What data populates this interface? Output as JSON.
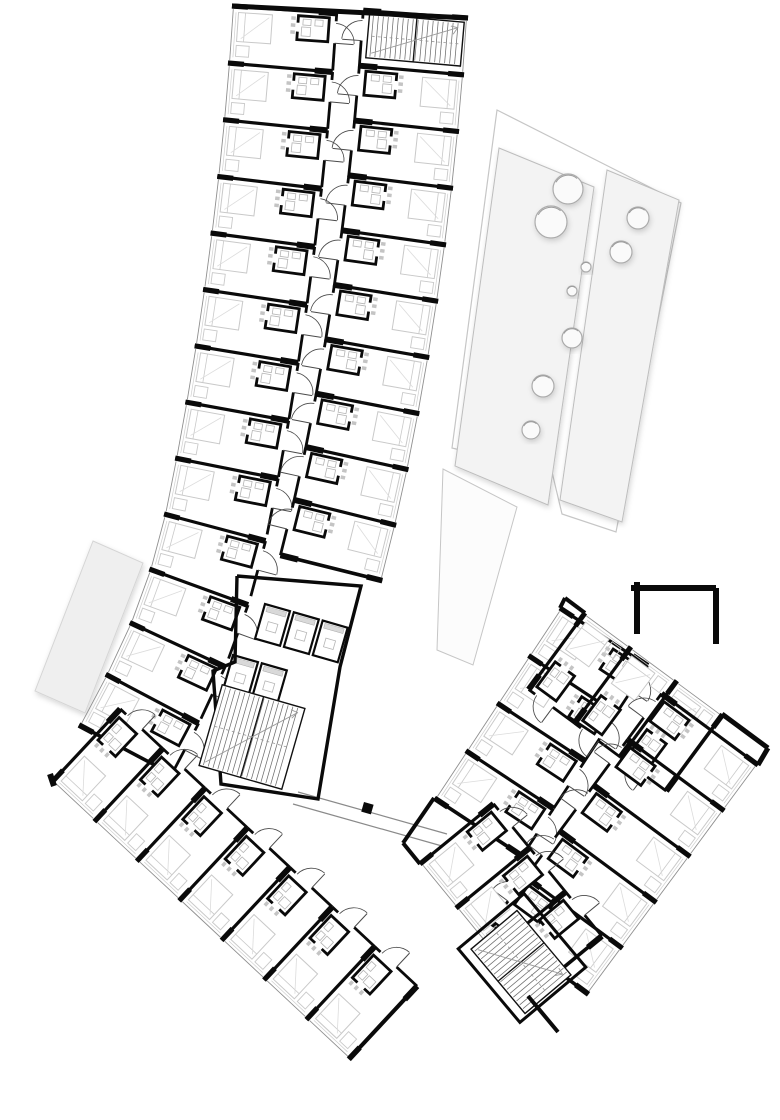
{
  "document": {
    "type": "architectural-floor-plan",
    "description": "upper floor plan, hotel wings with repeated room modules"
  },
  "colors": {
    "background": "#ffffff",
    "wall": "#0a0a0a",
    "window_line": "#8f8f8f",
    "window_line2": "#d0d0d0",
    "furniture": "#c9c9c9",
    "furniture_light": "#dcdcdc",
    "door": "#4a4a4a",
    "hatch": "#6e6e6e",
    "fixture": "#b5b5b5",
    "tick": "#c4c4c4",
    "terrace_line": "#c6c6c6",
    "terrace_fill": "#f7f7f7",
    "strip_fill": "#f3f3f3",
    "circle_fill": "#fafafa",
    "circle_line": "#ababab",
    "canopy_fill": "#efefef",
    "canopy_line": "#d5d5d5",
    "link_line": "#8a8a8a",
    "tail_fill": "#fcfcfc"
  },
  "canvas": {
    "w": 780,
    "h": 1120
  },
  "banks": [
    {
      "name": "north-wing-west-rooms",
      "side": -1,
      "depth": 105,
      "cap": true,
      "bare": [],
      "pts": [
        [
          232,
          6
        ],
        [
          228,
          63
        ],
        [
          223.1,
          119.7
        ],
        [
          217.3,
          176.4
        ],
        [
          210.6,
          233
        ],
        [
          203.1,
          289.4
        ],
        [
          194.7,
          345.8
        ],
        [
          185.4,
          402
        ],
        [
          175.2,
          458.1
        ],
        [
          164.1,
          514
        ],
        [
          149.4,
          569.1
        ],
        [
          129.9,
          622.6
        ],
        [
          105.8,
          674.3
        ]
      ],
      "end": [
        79,
        725
      ]
    },
    {
      "name": "north-wing-east-rooms",
      "side": 1,
      "depth": 105,
      "cap": true,
      "bare": [
        0
      ],
      "pts": [
        [
          468,
          18
        ],
        [
          464,
          74.9
        ],
        [
          459,
          131.6
        ],
        [
          453,
          188.3
        ],
        [
          446,
          244.9
        ],
        [
          438.1,
          301.3
        ],
        [
          429.2,
          357.6
        ],
        [
          419.3,
          413.7
        ],
        [
          408.4,
          469.7
        ],
        [
          396.1,
          525.3
        ]
      ],
      "end": [
        382.3,
        580.6
      ]
    },
    {
      "name": "south-wing-rooms",
      "side": -1,
      "depth": 100,
      "cap": true,
      "bare": [],
      "pts": [
        [
          52,
          782
        ],
        [
          94.4,
          821.6
        ],
        [
          136.8,
          861.2
        ],
        [
          179.2,
          900.8
        ],
        [
          221.6,
          940.4
        ],
        [
          264,
          980
        ],
        [
          306.4,
          1019.6
        ]
      ],
      "end": [
        348.8,
        1059.2
      ]
    },
    {
      "name": "east-wing-nw-rooms",
      "side": -1,
      "depth": 105,
      "cap": true,
      "bare": [],
      "pts": [
        [
          560,
          608
        ],
        [
          528.6,
          655.6
        ],
        [
          497.2,
          703.1
        ],
        [
          465.9,
          750.7
        ]
      ],
      "end": [
        434.5,
        798.2
      ]
    },
    {
      "name": "east-wing-ne-rooms",
      "side": 1,
      "depth": 95,
      "cap": true,
      "bare": [],
      "pts": [
        [
          585,
          613
        ],
        [
          630.9,
          646.8
        ],
        [
          676.8,
          680.7
        ]
      ],
      "end": [
        722.6,
        714.5
      ]
    },
    {
      "name": "east-wing-se-rooms",
      "side": 1,
      "depth": 120,
      "cap": true,
      "bare": [],
      "pts": [
        [
          758,
          765
        ],
        [
          724.1,
          810.8
        ],
        [
          690.2,
          856.7
        ],
        [
          656.3,
          902.5
        ],
        [
          622.4,
          948.3
        ]
      ],
      "end": [
        588.5,
        994.2
      ]
    },
    {
      "name": "east-wing-sw-rooms",
      "side": -1,
      "depth": 95,
      "cap": true,
      "bare": [],
      "pts": [
        [
          420,
          864
        ],
        [
          456.1,
          908.1
        ],
        [
          492.2,
          952.2
        ]
      ],
      "end": [
        528.4,
        996.3
      ]
    }
  ],
  "stairs": [
    {
      "cx": 415,
      "cy": 40,
      "w": 95,
      "h": 44,
      "a": 5
    },
    {
      "cx": 252,
      "cy": 737,
      "w": 86,
      "h": 84,
      "a": 16
    },
    {
      "cx": 521,
      "cy": 962,
      "w": 84,
      "h": 60,
      "a": 50
    }
  ],
  "elevator_rows": [
    {
      "x": 265,
      "y": 604,
      "a": 16,
      "n": 3,
      "pitch": 30,
      "cw": 26,
      "ch": 36
    },
    {
      "x": 233,
      "y": 655,
      "a": 16,
      "n": 2,
      "pitch": 30,
      "cw": 26,
      "ch": 36
    }
  ],
  "core_polygon": [
    [
      237,
      576
    ],
    [
      361,
      586
    ],
    [
      340,
      667
    ],
    [
      318,
      799
    ],
    [
      221,
      784
    ],
    [
      213,
      671
    ],
    [
      235,
      662
    ],
    [
      237,
      576
    ]
  ],
  "east_core_rect": {
    "cx": 522,
    "cy": 958,
    "w": 96,
    "h": 86,
    "a": 50
  },
  "heavy_walls": [
    [
      232,
      6,
      468,
      18,
      5
    ],
    [
      50,
      774,
      54,
      786,
      6
    ],
    [
      349,
      1059,
      415,
      988,
      4
    ],
    [
      528,
      996,
      558,
      1032,
      4
    ],
    [
      758,
      765,
      768,
      748,
      5
    ],
    [
      637,
      582,
      637,
      634,
      6
    ],
    [
      631,
      588,
      716,
      588,
      6
    ],
    [
      716,
      588,
      716,
      644,
      6
    ],
    [
      722,
      714,
      768,
      748,
      5
    ],
    [
      560,
      608,
      565,
      598,
      4
    ],
    [
      565,
      598,
      585,
      613,
      4
    ],
    [
      403,
      843,
      420,
      864,
      4
    ],
    [
      434,
      798,
      403,
      843,
      4
    ]
  ],
  "connector": {
    "lines": [
      [
        298,
        792,
        447,
        834
      ],
      [
        293,
        804,
        442,
        846
      ]
    ],
    "stub": [
      364,
      802,
      10,
      10,
      16
    ]
  },
  "terrace": {
    "outer": [
      [
        497,
        110
      ],
      [
        681,
        203
      ],
      [
        616,
        532
      ],
      [
        562,
        514
      ],
      [
        552,
        472
      ],
      [
        452,
        448
      ]
    ],
    "tail": [
      [
        443,
        469
      ],
      [
        517,
        507
      ],
      [
        473,
        665
      ],
      [
        437,
        650
      ]
    ],
    "strips": [
      [
        [
          499,
          148
        ],
        [
          594,
          187
        ],
        [
          548,
          505
        ],
        [
          455,
          466
        ]
      ],
      [
        [
          607,
          170
        ],
        [
          679,
          200
        ],
        [
          622,
          522
        ],
        [
          560,
          500
        ]
      ]
    ],
    "circles": [
      {
        "c": [
          568,
          189
        ],
        "r": 15
      },
      {
        "c": [
          551,
          222
        ],
        "r": 16
      },
      {
        "c": [
          638,
          218
        ],
        "r": 11
      },
      {
        "c": [
          621,
          252
        ],
        "r": 11
      },
      {
        "c": [
          586,
          267
        ],
        "r": 5
      },
      {
        "c": [
          572,
          291
        ],
        "r": 5
      },
      {
        "c": [
          572,
          338
        ],
        "r": 10
      },
      {
        "c": [
          543,
          386
        ],
        "r": 11
      },
      {
        "c": [
          531,
          430
        ],
        "r": 9
      }
    ]
  },
  "canopy": [
    [
      93,
      541
    ],
    [
      143,
      563
    ],
    [
      85,
      713
    ],
    [
      35,
      691
    ]
  ]
}
